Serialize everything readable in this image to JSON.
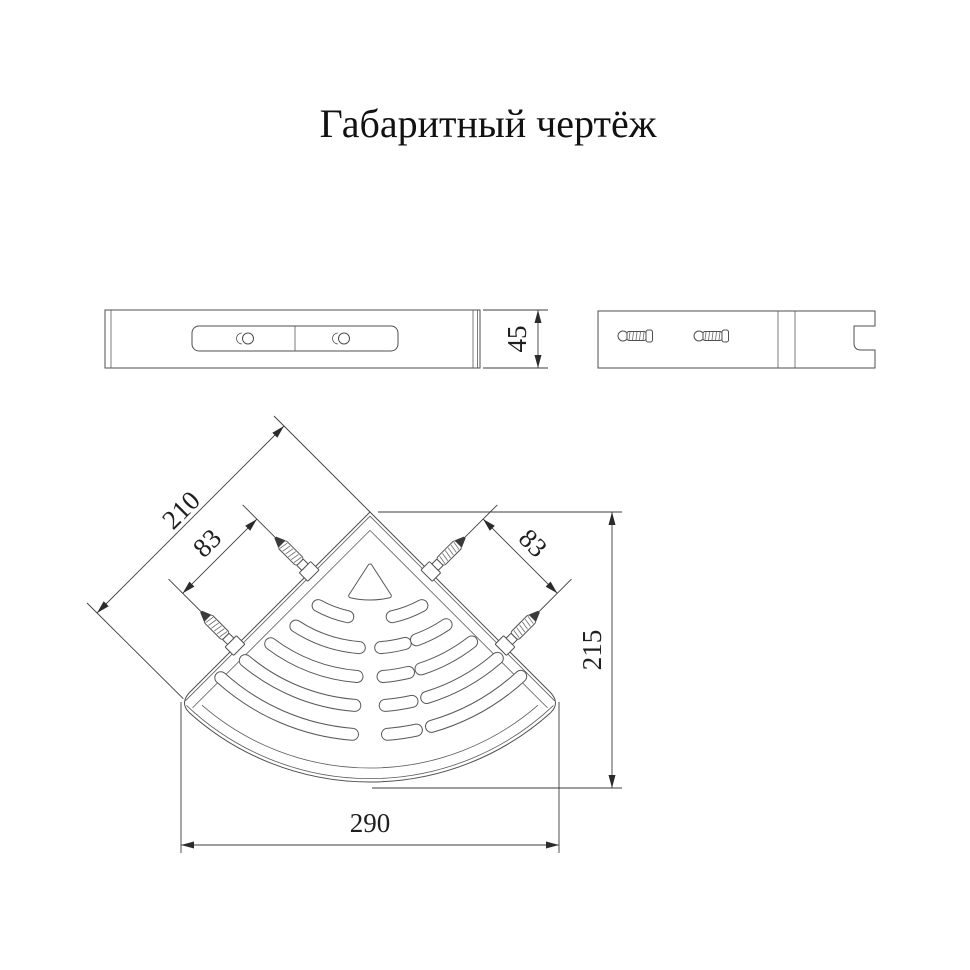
{
  "title": "Габаритный чертёж",
  "front_view": {
    "height_dim": "45"
  },
  "plan_view": {
    "edge_dim": "210",
    "left_spacing_dim": "83",
    "right_spacing_dim": "83",
    "height_dim": "215",
    "width_dim": "290"
  },
  "colors": {
    "line": "#4f4f4f",
    "text": "#1f1f1f",
    "arrow": "#2b2b2b",
    "background": "#ffffff"
  }
}
